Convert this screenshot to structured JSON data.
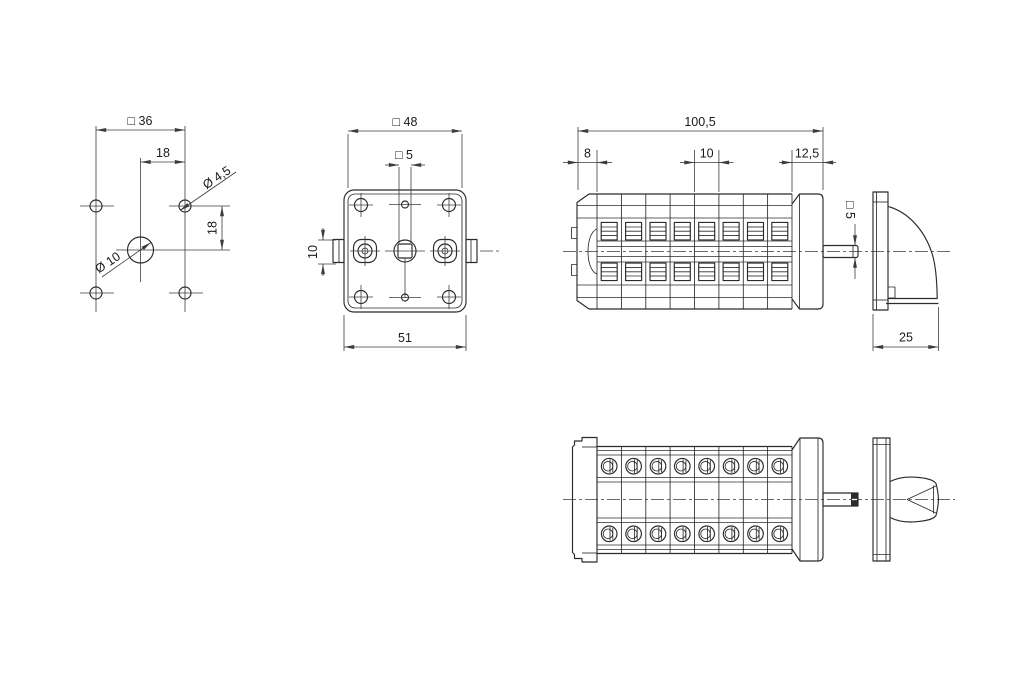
{
  "colors": {
    "background": "#ffffff",
    "object_line": "#2b2b2b",
    "dimension_line": "#3c3c3c",
    "text": "#1a1a1a"
  },
  "views": {
    "drill_template": {
      "dims": {
        "pattern_square": "□ 36",
        "hole_offset_h": "18",
        "hole_offset_v": "18",
        "corner_hole_dia": "Ø 4,5",
        "center_hole_dia": "Ø 10"
      }
    },
    "front": {
      "dims": {
        "face_square": "□ 48",
        "shaft_hole_square": "□ 5",
        "side_tab_height": "10",
        "overall_width": "51"
      }
    },
    "side": {
      "dims": {
        "overall_length": "100,5",
        "front_flange_depth": "8",
        "module_pitch": "10",
        "mounting_plate_depth": "12,5",
        "shaft_square": "□ 5",
        "handle_depth": "25"
      }
    }
  }
}
